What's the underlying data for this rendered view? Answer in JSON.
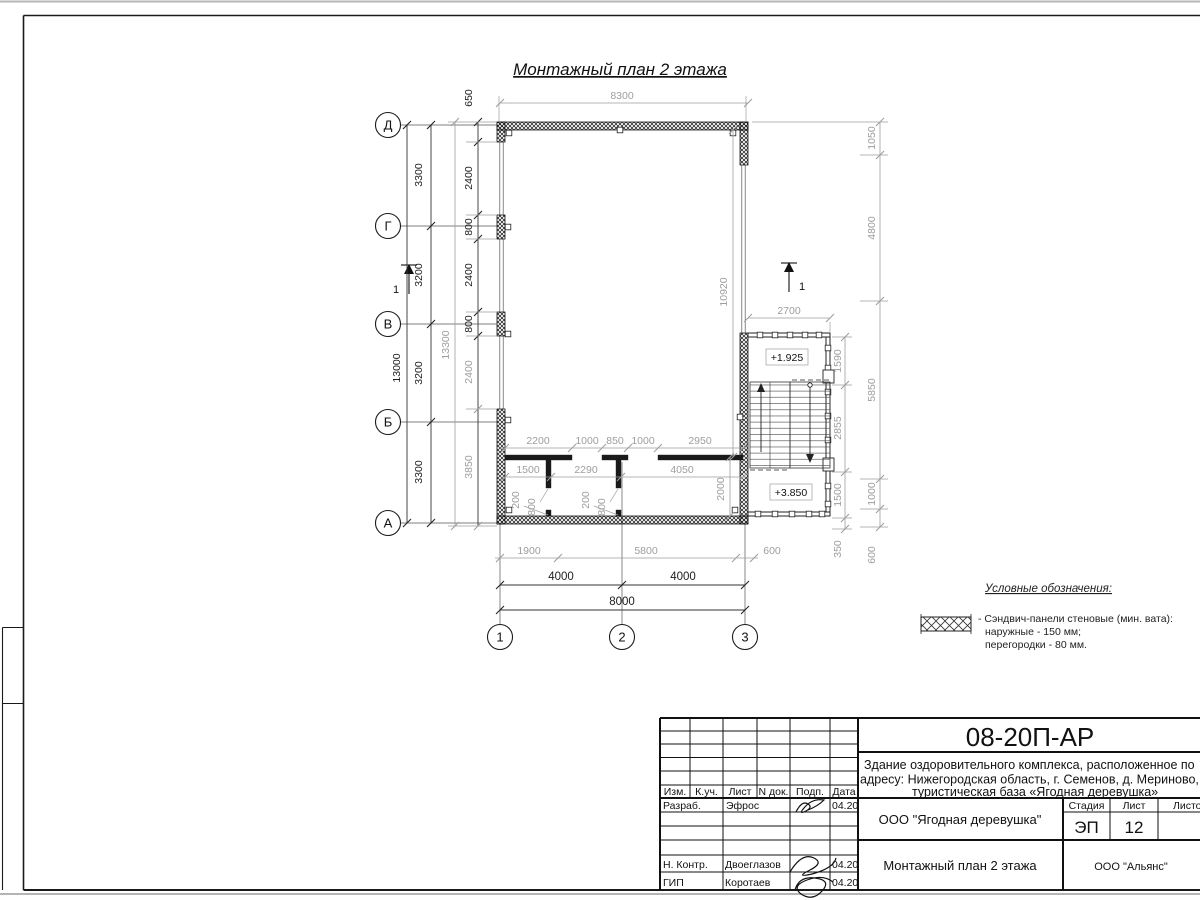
{
  "title": "Монтажный план 2 этажа",
  "axes": {
    "rows": [
      "Д",
      "Г",
      "В",
      "Б",
      "А"
    ],
    "cols": [
      "1",
      "2",
      "3"
    ]
  },
  "section_mark": "1",
  "levels": {
    "upper": "+1.925",
    "lower": "+3.850"
  },
  "dims": {
    "rows": [
      "3300",
      "3200",
      "3200",
      "3300"
    ],
    "rowsTotal": "13000",
    "refTotal": "13300",
    "leftWall": [
      "650",
      "2400",
      "800",
      "2400",
      "800",
      "2400",
      "3850"
    ],
    "topWidth": "8300",
    "rightOuter": [
      "1050",
      "4800",
      "5850",
      "1000",
      "600"
    ],
    "stairInner": [
      "1590",
      "2855",
      "1500",
      "350"
    ],
    "stairWidth": "2700",
    "hallHeight": "10920",
    "partTop": [
      "2200",
      "1000",
      "850",
      "1000",
      "2950"
    ],
    "partBottom": [
      "1500",
      "2290",
      "4050"
    ],
    "doorDims": [
      "200",
      "800",
      "200",
      "800"
    ],
    "roomDepth": "2000",
    "bottomRef": [
      "1900",
      "5800",
      "600"
    ],
    "cols": [
      "4000",
      "4000"
    ],
    "colsTotal": "8000"
  },
  "legend": {
    "heading": "Условные обозначения:",
    "line1": "- Сэндвич-панели стеновые (мин. вата):",
    "line2": "наружные - 150 мм;",
    "line3": "перегородки - 80 мм."
  },
  "titleblock": {
    "doc_number": "08-20П-АР",
    "project_line1": "Здание оздоровительного комплекса, расположенное по",
    "project_line2": "адресу: Нижегородская область, г. Семенов, д. Мериново,",
    "project_line3": "туристическая база «Ягодная деревушка»",
    "headers": {
      "izm": "Изм.",
      "kuch": "К.уч.",
      "list": "Лист",
      "ndok": "N док.",
      "podp": "Подп.",
      "data": "Дата",
      "stadia": "Стадия",
      "list2": "Лист",
      "listov": "Листов"
    },
    "rows": {
      "r1_role": "Разраб.",
      "r1_name": "Эфрос",
      "r1_date": "04.20",
      "r2_role": "Н. Контр.",
      "r2_name": "Двоеглазов",
      "r2_date": "04.20",
      "r3_role": "ГИП",
      "r3_name": "Коротаев",
      "r3_date": "04.20"
    },
    "stage_value": "ЭП",
    "sheet_value": "12",
    "client": "ООО \"Ягодная деревушка\"",
    "sheet_name": "Монтажный план 2 этажа",
    "org": "ООО \"Альянс\""
  }
}
